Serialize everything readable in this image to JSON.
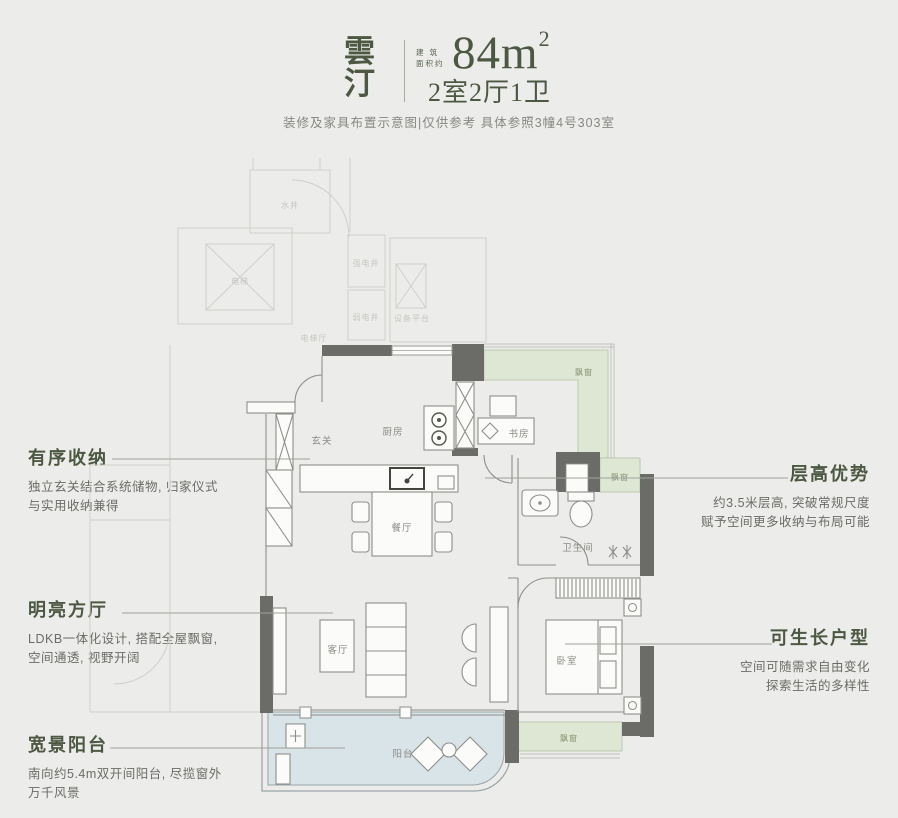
{
  "header": {
    "title": "雲汀",
    "area_label_line1": "建 筑",
    "area_label_line2": "面积约",
    "area_value": "84m",
    "area_sup": "2",
    "spec": "2室2厅1卫",
    "disclaimer": "装修及家具布置示意图|仅供参考 具体参照3幢4号303室"
  },
  "annotations_left": [
    {
      "title": "有序收纳",
      "line1": "独立玄关结合系统储物, 归家仪式",
      "line2": "与实用收纳兼得"
    },
    {
      "title": "明亮方厅",
      "line1": "LDKB一体化设计, 搭配全屋飘窗,",
      "line2": "空间通透, 视野开阔"
    },
    {
      "title": "宽景阳台",
      "line1": "南向约5.4m双开间阳台, 尽揽窗外",
      "line2": "万千风景"
    }
  ],
  "annotations_right": [
    {
      "title": "层高优势",
      "line1": "约3.5米层高, 突破常规尺度",
      "line2": "赋予空间更多收纳与布局可能"
    },
    {
      "title": "可生长户型",
      "line1": "空间可随需求自由变化",
      "line2": "探索生活的多样性"
    }
  ],
  "floorplan": {
    "rooms": {
      "entry": "玄关",
      "kitchen": "厨房",
      "study": "书房",
      "dining": "餐厅",
      "bathroom": "卫生间",
      "living": "客厅",
      "bedroom": "卧室",
      "balcony": "阳台"
    },
    "bay_window_top": "飘窗",
    "bay_window_right": "飘窗",
    "bay_window_bottom": "飘窗",
    "common": {
      "water_shaft": "水井",
      "elevator": "电梯",
      "strong_elec_shaft": "强电井",
      "weak_elec_shaft": "弱电井",
      "equipment_platform": "设备平台",
      "elevator_hall": "电梯厅"
    },
    "colors": {
      "accent_green": "#4d5843",
      "wall": "#6b6b67",
      "bay_window": "#dee7d3",
      "balcony": "#d8e4e8",
      "line": "#8e8e8a",
      "faint": "#cfcfcb",
      "text_gray": "#6b6b67"
    }
  }
}
